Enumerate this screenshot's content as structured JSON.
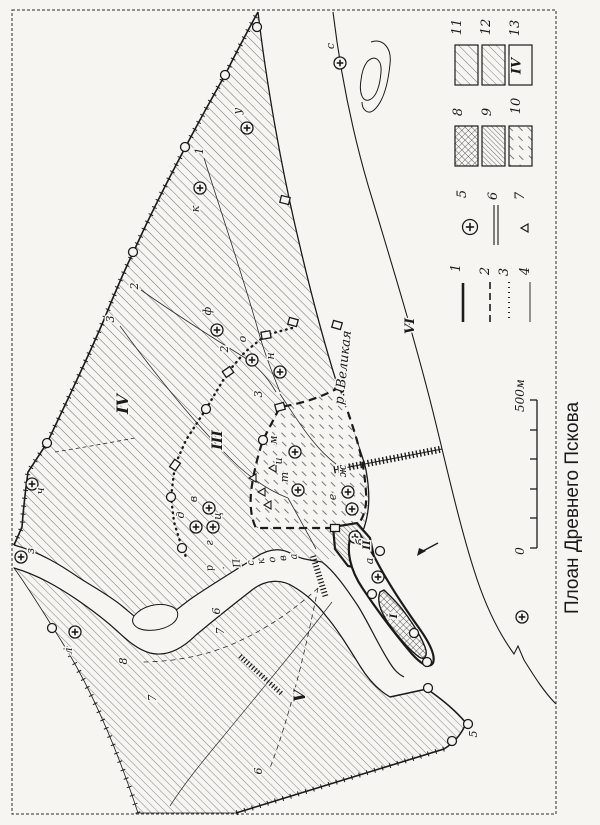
{
  "page": {
    "title": "Плоан Древнего Пскова",
    "ink": "#1b1b1b",
    "bg": "#f6f5f1"
  },
  "rivers": [
    {
      "name": "р. Великая",
      "x": 347,
      "y": 368,
      "rot": -84,
      "size": 13
    },
    {
      "name": "р. Пскова",
      "x": 213,
      "y": 571,
      "rot": -8,
      "size": 10,
      "per_glyph": true
    }
  ],
  "regions": [
    {
      "numeral": "I",
      "x": 397,
      "y": 616,
      "size": 10
    },
    {
      "numeral": "II",
      "x": 370,
      "y": 545,
      "size": 10
    },
    {
      "numeral": "III",
      "x": 222,
      "y": 440,
      "size": 14
    },
    {
      "numeral": "IV",
      "x": 128,
      "y": 404,
      "size": 16
    },
    {
      "numeral": "V",
      "x": 305,
      "y": 696,
      "size": 16
    },
    {
      "numeral": "VI",
      "x": 414,
      "y": 326,
      "size": 13
    }
  ],
  "churches": [
    {
      "x": 340,
      "y": 63,
      "l": "с",
      "lx": 334,
      "ly": 46
    },
    {
      "x": 247,
      "y": 128,
      "l": "у",
      "lx": 241,
      "ly": 111
    },
    {
      "x": 200,
      "y": 188,
      "l": "к",
      "lx": 199,
      "ly": 209
    },
    {
      "x": 217,
      "y": 330,
      "l": "ф",
      "lx": 211,
      "ly": 311
    },
    {
      "x": 252,
      "y": 360,
      "l": "о",
      "lx": 246,
      "ly": 339
    },
    {
      "x": 280,
      "y": 372,
      "l": "н",
      "lx": 274,
      "ly": 356
    },
    {
      "x": 32,
      "y": 484,
      "l": "ч",
      "lx": 44,
      "ly": 491
    },
    {
      "x": 21,
      "y": 557,
      "l": "з",
      "lx": 34,
      "ly": 551
    },
    {
      "x": 209,
      "y": 508
    },
    {
      "x": 196,
      "y": 527
    },
    {
      "x": 213,
      "y": 527
    },
    {
      "x": 295,
      "y": 452,
      "l": "м",
      "lx": 277,
      "ly": 440
    },
    {
      "x": 298,
      "y": 490,
      "l": "т",
      "lx": 288,
      "ly": 477
    },
    {
      "x": 348,
      "y": 492,
      "l": "ж",
      "lx": 346,
      "ly": 471
    },
    {
      "x": 352,
      "y": 509,
      "l": "е",
      "lx": 336,
      "ly": 497
    },
    {
      "x": 355,
      "y": 537,
      "l": "б",
      "lx": 364,
      "ly": 542
    },
    {
      "x": 378,
      "y": 577,
      "l": "а",
      "lx": 373,
      "ly": 561
    },
    {
      "x": 75,
      "y": 632,
      "l": "л",
      "lx": 72,
      "ly": 651
    },
    {
      "x": 522,
      "y": 617
    }
  ],
  "letters": [
    {
      "t": "и",
      "x": 282,
      "y": 461
    },
    {
      "t": "в",
      "x": 197,
      "y": 499
    },
    {
      "t": "д",
      "x": 184,
      "y": 515
    },
    {
      "t": "ц",
      "x": 221,
      "y": 516
    },
    {
      "t": "г",
      "x": 213,
      "y": 543
    }
  ],
  "numbers": [
    {
      "n": "1",
      "x": 203,
      "y": 151
    },
    {
      "n": "2",
      "x": 138,
      "y": 286
    },
    {
      "n": "3",
      "x": 114,
      "y": 319
    },
    {
      "n": "2",
      "x": 228,
      "y": 349
    },
    {
      "n": "3",
      "x": 262,
      "y": 394
    },
    {
      "n": "6",
      "x": 220,
      "y": 611
    },
    {
      "n": "7",
      "x": 224,
      "y": 631
    },
    {
      "n": "8",
      "x": 127,
      "y": 661
    },
    {
      "n": "7",
      "x": 156,
      "y": 698
    },
    {
      "n": "6",
      "x": 262,
      "y": 771
    },
    {
      "n": "5",
      "x": 477,
      "y": 734
    }
  ],
  "towers": [
    [
      257,
      27
    ],
    [
      225,
      75
    ],
    [
      185,
      147
    ],
    [
      133,
      252
    ],
    [
      47,
      443
    ],
    [
      206,
      409
    ],
    [
      171,
      497
    ],
    [
      182,
      548
    ],
    [
      263,
      440
    ],
    [
      380,
      551
    ],
    [
      372,
      594
    ],
    [
      414,
      633
    ],
    [
      427,
      662
    ],
    [
      52,
      628
    ],
    [
      428,
      688
    ],
    [
      468,
      724
    ],
    [
      452,
      741
    ]
  ],
  "gates": [
    {
      "x": 285,
      "y": 200,
      "a": 14
    },
    {
      "x": 293,
      "y": 322,
      "a": 16
    },
    {
      "x": 337,
      "y": 325,
      "a": 16
    },
    {
      "x": 266,
      "y": 335,
      "a": -10
    },
    {
      "x": 228,
      "y": 372,
      "a": -35
    },
    {
      "x": 175,
      "y": 465,
      "a": -55
    },
    {
      "x": 340,
      "y": 387,
      "a": 20
    },
    {
      "x": 280,
      "y": 407,
      "a": -15
    },
    {
      "x": 335,
      "y": 528,
      "a": 0
    }
  ],
  "triangles": [
    [
      273,
      468
    ],
    [
      262,
      492
    ],
    [
      268,
      505
    ],
    [
      253,
      478
    ]
  ],
  "arrow": {
    "x": 427,
    "y": 549
  },
  "scale": {
    "zero": "0",
    "end": "500м",
    "x": 537,
    "y1": 400,
    "y2": 548,
    "ticks": [
      400,
      430,
      459,
      489,
      518,
      548
    ]
  },
  "legend": {
    "items": [
      {
        "num": "1",
        "kind": "line",
        "style": "solid-thick",
        "label": [
          460,
          268
        ],
        "line": [
          463,
          283,
          463,
          322
        ]
      },
      {
        "num": "2",
        "kind": "line",
        "style": "dashed",
        "label": [
          489,
          271
        ],
        "line": [
          490,
          282,
          490,
          322
        ]
      },
      {
        "num": "3",
        "kind": "line",
        "style": "dotted",
        "label": [
          508,
          272
        ],
        "line": [
          509,
          282,
          509,
          322
        ]
      },
      {
        "num": "4",
        "kind": "line",
        "style": "thin",
        "label": [
          529,
          271
        ],
        "line": [
          530,
          282,
          530,
          322
        ]
      },
      {
        "num": "5",
        "kind": "church",
        "style": "church-symbol",
        "label": [
          466,
          194
        ],
        "cx": 470,
        "cy": 227
      },
      {
        "num": "6",
        "kind": "double",
        "style": "double-line",
        "label": [
          497,
          196
        ],
        "line": [
          496,
          205,
          496,
          245
        ]
      },
      {
        "num": "7",
        "kind": "triangle",
        "style": "triangle-mark",
        "label": [
          524,
          196
        ],
        "cx": 525,
        "cy": 228
      },
      {
        "num": "8",
        "kind": "swatch",
        "pattern": "pat8",
        "label": [
          462,
          112
        ],
        "rect": [
          455,
          126,
          23,
          40
        ]
      },
      {
        "num": "9",
        "kind": "swatch",
        "pattern": "pat9",
        "label": [
          491,
          112
        ],
        "rect": [
          482,
          126,
          23,
          40
        ]
      },
      {
        "num": "10",
        "kind": "swatch",
        "pattern": "pat10",
        "label": [
          520,
          106
        ],
        "rect": [
          509,
          126,
          23,
          40
        ]
      },
      {
        "num": "11",
        "kind": "swatch",
        "pattern": "pat11",
        "label": [
          461,
          27
        ],
        "rect": [
          455,
          45,
          23,
          40
        ]
      },
      {
        "num": "12",
        "kind": "swatch",
        "pattern": "pat12",
        "label": [
          490,
          27
        ],
        "rect": [
          482,
          45,
          23,
          40
        ]
      },
      {
        "num": "13",
        "kind": "numeral",
        "numeral": "IV",
        "label": [
          519,
          28
        ],
        "rect": [
          509,
          45,
          23,
          40
        ]
      }
    ]
  }
}
